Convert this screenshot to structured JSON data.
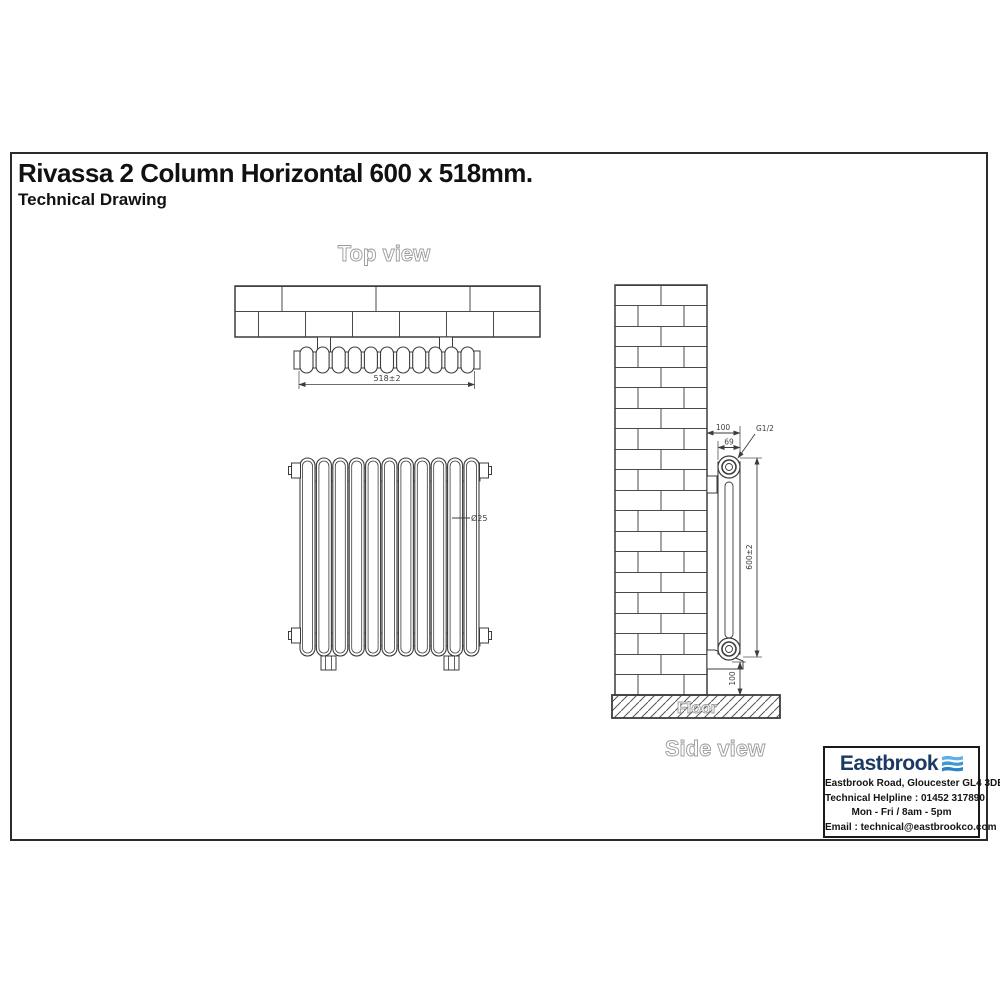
{
  "page": {
    "title": "Rivassa 2 Column Horizontal 600 x 518mm.",
    "subtitle": "Technical Drawing"
  },
  "views": {
    "top_view": {
      "label": "Top view",
      "width_dim": "518±2"
    },
    "front_view": {
      "column_diameter_dim": "Ø25"
    },
    "side_view": {
      "label": "Side view",
      "floor_label": "Floor",
      "wall_offset_dim": "100",
      "depth_dim": "69",
      "connection_dim": "G1/2",
      "height_dim": "600±2",
      "floor_clearance_dim": "100"
    }
  },
  "infobox": {
    "brand": "Eastbrook",
    "address": "Eastbrook Road, Gloucester GL4 3DB",
    "helpline": "Technical Helpline : 01452 317890",
    "hours": "Mon - Fri / 8am - 5pm",
    "email": "Email : technical@eastbrookco.com",
    "colors": {
      "brand_navy": "#1b3a63",
      "brand_blue_light": "#5fb0e5",
      "brand_blue_mid": "#3f97d3",
      "brand_blue_dark": "#2b84c4"
    }
  }
}
